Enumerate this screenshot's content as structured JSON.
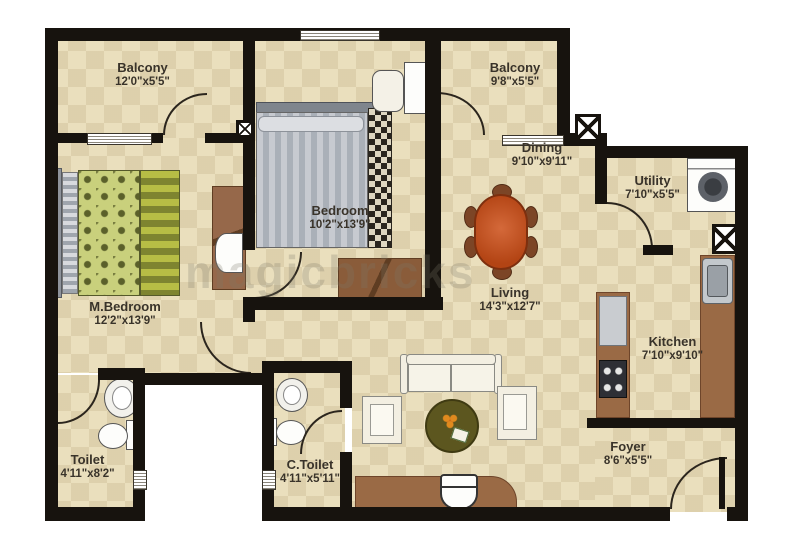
{
  "watermark": "magicbricks",
  "rooms": [
    {
      "name": "Balcony",
      "dims": "12'0\"x5'5\""
    },
    {
      "name": "Bedroom",
      "dims": "10'2\"x13'9\""
    },
    {
      "name": "Balcony",
      "dims": "9'8\"x5'5\""
    },
    {
      "name": "Dining",
      "dims": "9'10\"x9'11\""
    },
    {
      "name": "Utility",
      "dims": "7'10\"x5'5\""
    },
    {
      "name": "Living",
      "dims": "14'3\"x12'7\""
    },
    {
      "name": "M.Bedroom",
      "dims": "12'2\"x13'9\""
    },
    {
      "name": "Kitchen",
      "dims": "7'10\"x9'10\""
    },
    {
      "name": "Toilet",
      "dims": "4'11\"x8'2\""
    },
    {
      "name": "C.Toilet",
      "dims": "4'11\"x5'11\""
    },
    {
      "name": "Foyer",
      "dims": "8'6\"x5'5\""
    }
  ],
  "palette": {
    "wall": "#17130e",
    "floor": "#eadfbd",
    "counter": "#9a6a45",
    "dining_table": "#c2511f",
    "rug": "#5c561f",
    "bed_green": "#c9d07c",
    "bed_gray": "#b4b8be"
  }
}
